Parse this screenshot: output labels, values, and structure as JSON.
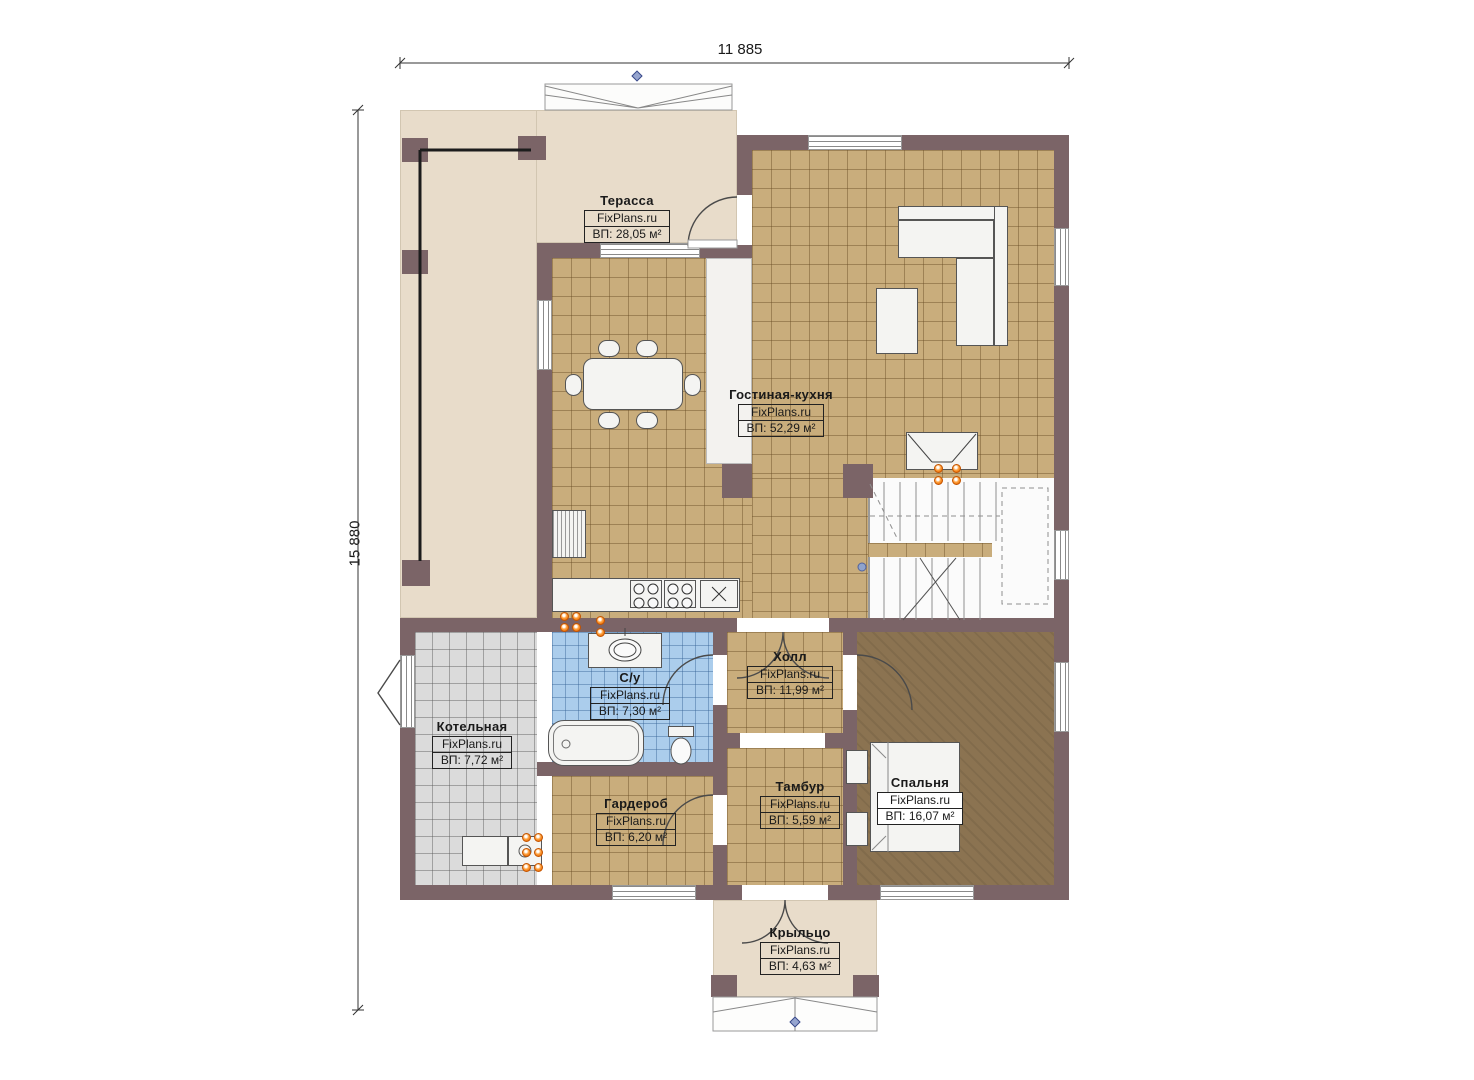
{
  "watermark": "FixPlans.ru",
  "dimensions": {
    "width_label": "11 885",
    "height_label": "15 880"
  },
  "rooms": [
    {
      "name": "Терасса",
      "area": "ВП: 28,05 м²"
    },
    {
      "name": "Гостиная-кухня",
      "area": "ВП: 52,29 м²"
    },
    {
      "name": "Холл",
      "area": "ВП: 11,99 м²"
    },
    {
      "name": "С/у",
      "area": "ВП: 7,30 м²"
    },
    {
      "name": "Котельная",
      "area": "ВП: 7,72 м²"
    },
    {
      "name": "Гардероб",
      "area": "ВП: 6,20 м²"
    },
    {
      "name": "Тамбур",
      "area": "ВП: 5,59 м²"
    },
    {
      "name": "Спальня",
      "area": "ВП: 16,07 м²"
    },
    {
      "name": "Крыльцо",
      "area": "ВП: 4,63 м²"
    }
  ],
  "colors": {
    "wall": "#7b6467",
    "tile_tan": "#c9ad7c",
    "tile_blue": "#abcdec",
    "tile_gray": "#dbdbdb",
    "floor_beige": "#e8dcca",
    "carpet_brown": "#8b7351",
    "socket_orange": "#f07800",
    "marker_blue": "#96a5cf"
  }
}
